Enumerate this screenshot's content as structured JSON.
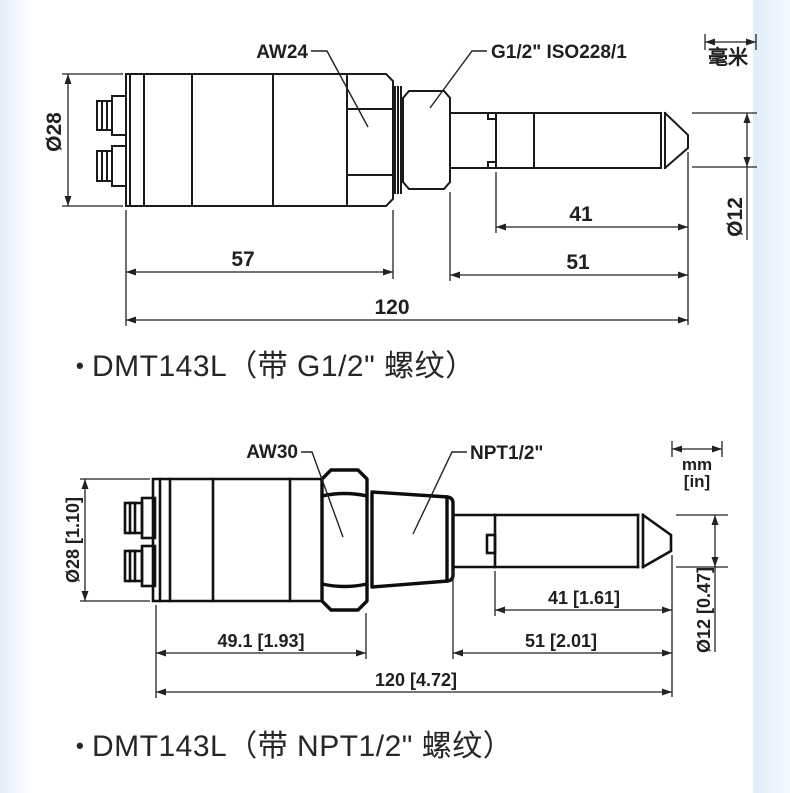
{
  "bullet": "•",
  "units": {
    "metric_only": "毫米",
    "dual_mm": "mm",
    "dual_in": "[in]"
  },
  "g12": {
    "caption": "DMT143L（带 G1/2\" 螺纹）",
    "wrench_label": "AW24",
    "thread_label": "G1/2\" ISO228/1",
    "dim_body_diameter": "Ø28",
    "dim_probe_diameter": "Ø12",
    "dim_probe_length": "41",
    "dim_shaft_length": "51",
    "dim_body_length": "57",
    "dim_total_length": "120"
  },
  "npt": {
    "caption": "DMT143L（带 NPT1/2\" 螺纹）",
    "wrench_label": "AW30",
    "thread_label": "NPT1/2\"",
    "dim_body_diameter": "Ø28 [1.10]",
    "dim_probe_diameter": "Ø12 [0.47]",
    "dim_probe_length": "41 [1.61]",
    "dim_shaft_length": "51 [2.01]",
    "dim_body_length": "49.1 [1.93]",
    "dim_total_length": "120 [4.72]"
  },
  "colors": {
    "line": "#1a1a1a",
    "dimension": "#222222",
    "edge_tint": "#e2edf8"
  }
}
